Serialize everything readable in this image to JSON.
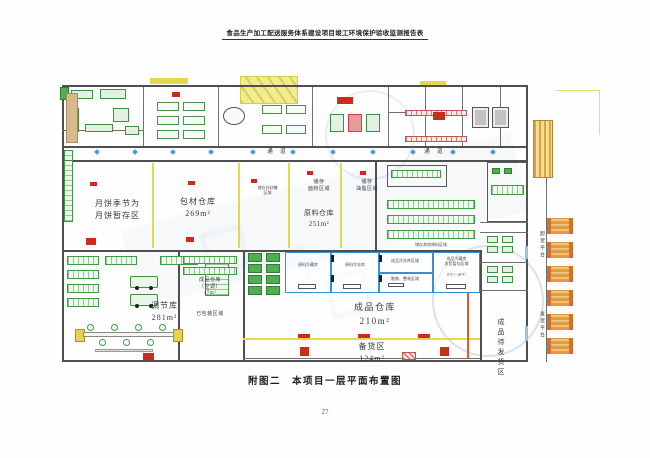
{
  "header": {
    "title": "食品生产加工配送服务体系建设项目竣工环境保护验收监测报告表"
  },
  "caption": "附图二　本项目一层平面布置图",
  "page_number": "27",
  "plan": {
    "corridor_labels": [
      "通 道",
      "通 道"
    ],
    "zones": {
      "mooncake": "月饼季节为\n月饼暂存区",
      "packing_material": "包材仓库\n269m²",
      "sugar": "储存白砂糖\n区域",
      "flour": "储存\n面粉区域",
      "oil": "储存\n油脂区域",
      "raw_material": "原料仓库\n251m²",
      "other_raw": "储存其他原料区域",
      "regulating": "调节库\n281m²",
      "finished_ac": "成品仓库\n（空调）\n47m²",
      "packed": "已包装区域",
      "finished": "成品仓库\n210m²",
      "stock_prep": "备货区\n124m²",
      "awaiting_delivery": "成品待发货区",
      "unloading_platform": "卸货平台",
      "delivery_platform": "发货平台",
      "cold_raw_chill": "原料冷藏库",
      "cold_raw_freeze": "原料冷冻库",
      "cold_finished_freeze": "成品冷冻库区域",
      "cold_bulk": "散装、整装区域",
      "cold_finished_chill": "成品冷藏库\n发货暂存区域",
      "cold_temp": "0℃~-18℃"
    },
    "colors": {
      "wall": "#4f4f4f",
      "zone_line_yellow": "#e3d84e",
      "shelving_green": "#3f9b3f",
      "marker_red": "#cf2b1d",
      "cold_room_blue": "#3a8fd0",
      "truck_orange": "#e89a40"
    }
  }
}
